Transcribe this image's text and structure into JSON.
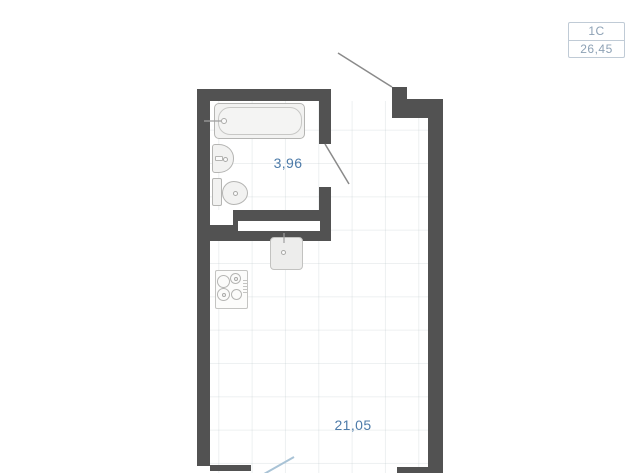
{
  "badge": {
    "unit_type": "1С",
    "total_area": "26,45"
  },
  "rooms": [
    {
      "name": "bathroom",
      "area_label": "3,96"
    },
    {
      "name": "living-kitchen",
      "area_label": "21,05"
    }
  ],
  "fixtures": [
    "bathtub",
    "bathroom-sink",
    "toilet",
    "kitchen-sink",
    "stove"
  ],
  "colors": {
    "wall": "#525252",
    "label": "#4d7ba9",
    "badge_border": "#c0cbd6",
    "badge_text": "#8da1b5",
    "door_swing": "#8a8a8a",
    "balcony_door": "#a9c3d6",
    "fixture_fill": "#f2f2f1",
    "fixture_border": "#b5b5b3"
  }
}
